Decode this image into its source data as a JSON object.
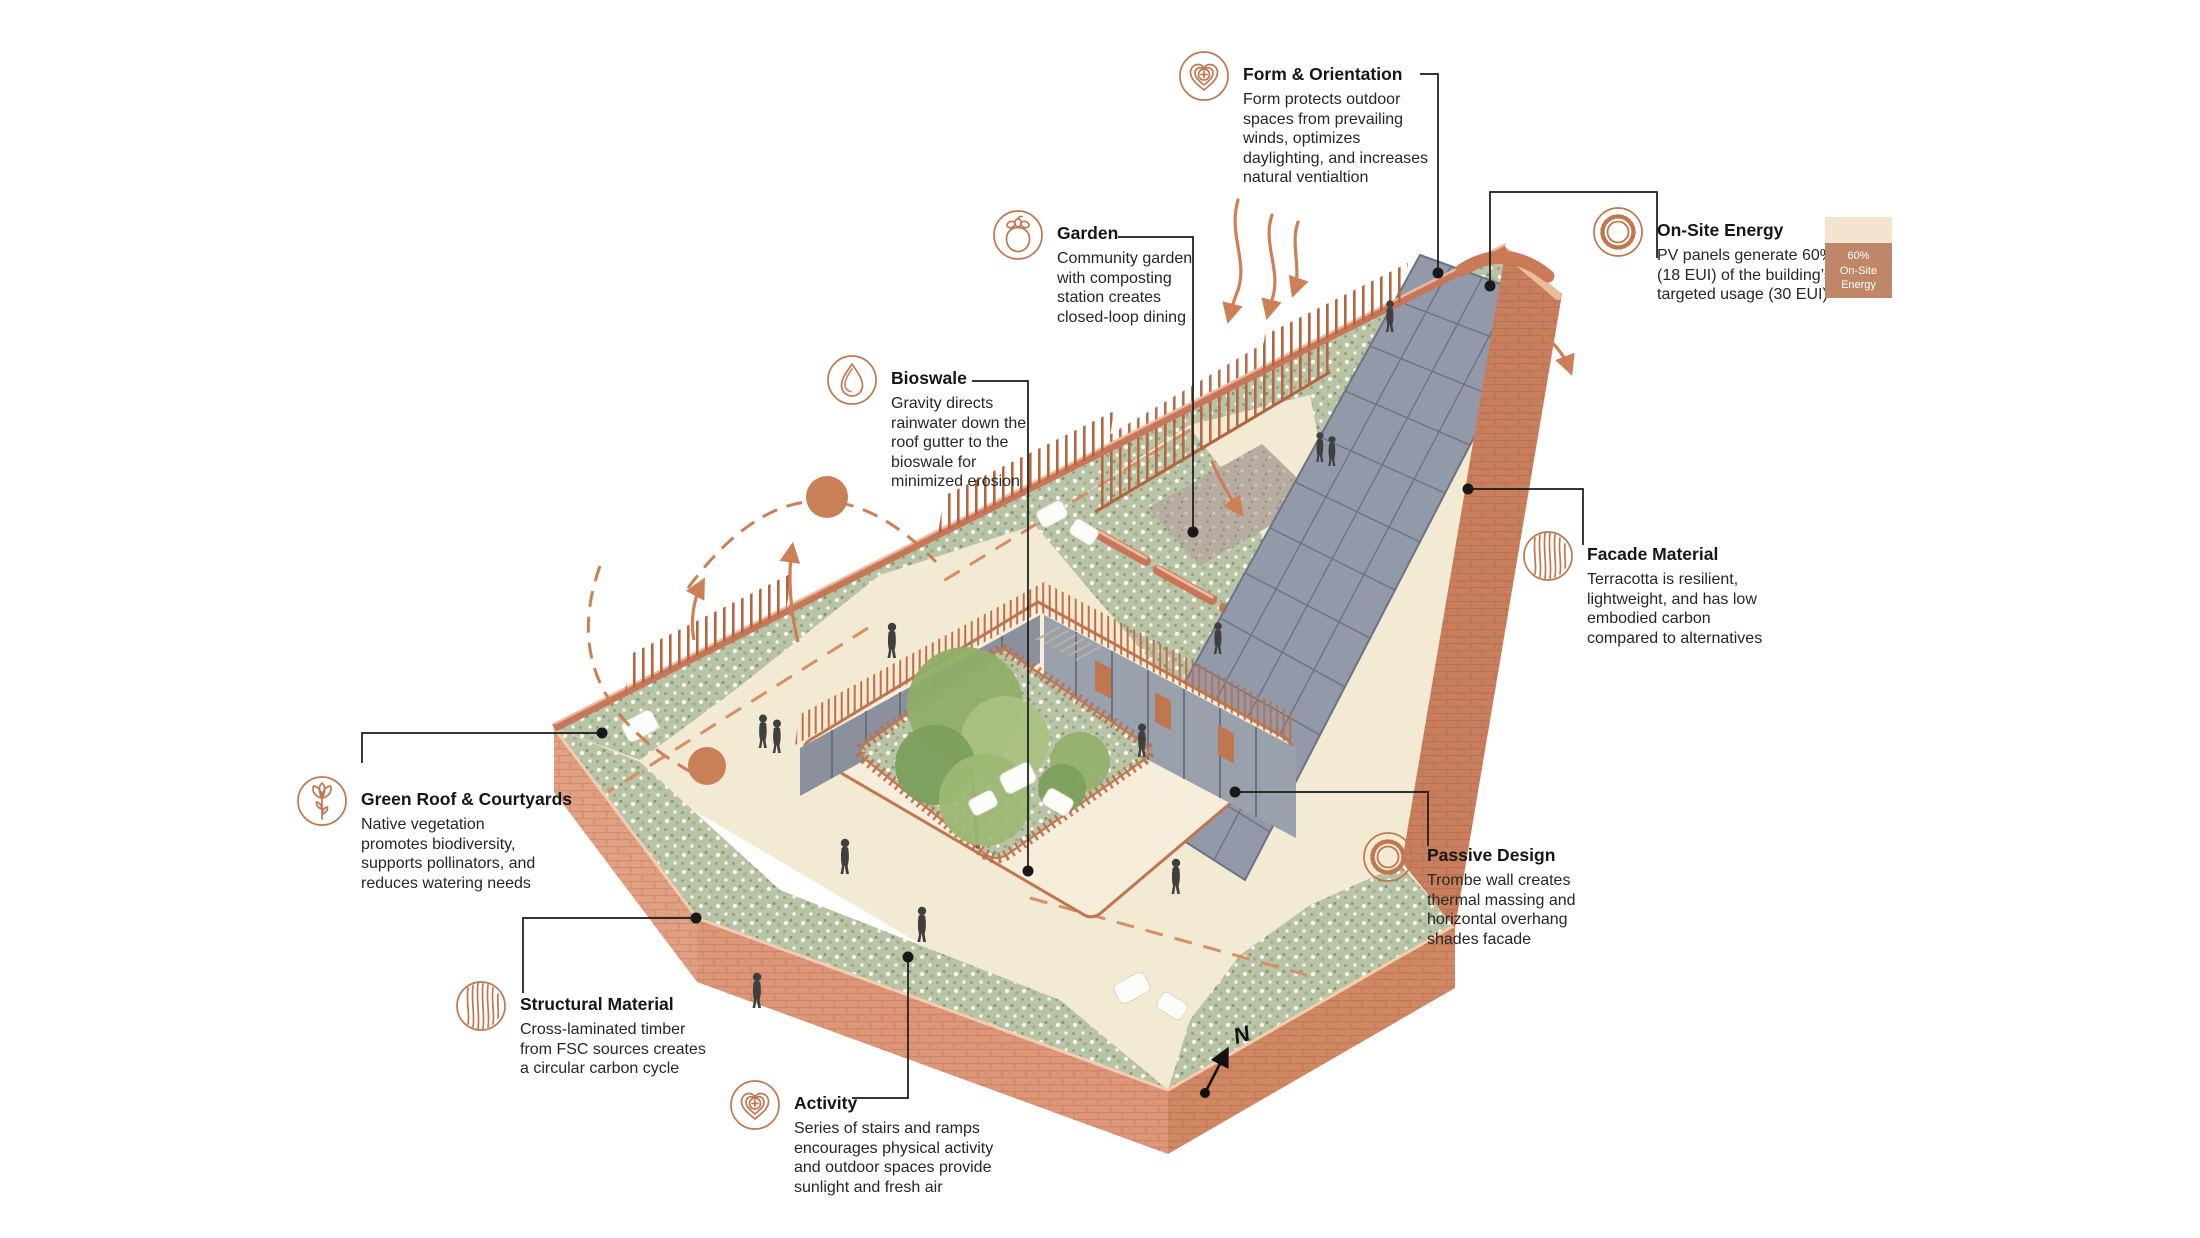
{
  "diagram_title": "Sustainable building design axonometric diagram",
  "callouts": [
    {
      "id": "form-orientation",
      "icon": "wellness-heart-icon",
      "title": "Form & Orientation",
      "body": "Form protects outdoor\nspaces from prevailing\nwinds, optimizes\ndaylighting, and increases\nnatural ventialtion"
    },
    {
      "id": "garden",
      "icon": "fruit-icon",
      "title": "Garden",
      "body": "Community garden\nwith composting\nstation creates\nclosed-loop dining"
    },
    {
      "id": "bioswale",
      "icon": "water-drop-icon",
      "title": "Bioswale",
      "body": "Gravity directs\nrainwater down the\nroof gutter to the\nbioswale for\nminimized erosion"
    },
    {
      "id": "on-site-energy",
      "icon": "sun-icon",
      "title": "On-Site Energy",
      "body": "PV panels generate 60%\n(18 EUI) of the building’s\ntargeted usage (30 EUI)"
    },
    {
      "id": "facade-material",
      "icon": "wood-grain-icon",
      "title": "Facade Material",
      "body": "Terracotta is resilient,\nlightweight, and has low\nembodied carbon\ncompared to alternatives"
    },
    {
      "id": "green-roof",
      "icon": "flower-icon",
      "title": "Green Roof & Courtyards",
      "body": "Native vegetation\npromotes biodiversity,\nsupports pollinators, and\nreduces watering needs"
    },
    {
      "id": "structural-material",
      "icon": "wood-grain-icon",
      "title": "Structural Material",
      "body": "Cross-laminated timber\nfrom FSC sources creates\na circular carbon cycle"
    },
    {
      "id": "activity",
      "icon": "wellness-heart-icon",
      "title": "Activity",
      "body": "Series of stairs and ramps\nencourages physical activity\nand outdoor spaces provide\nsunlight and fresh air"
    },
    {
      "id": "passive-design",
      "icon": "sun-icon",
      "title": "Passive Design",
      "body": "Trombe wall creates\nthermal massing and\nhorizontal overhang\nshades facade"
    }
  ],
  "energy_legend": {
    "percent": "60%",
    "label_line1": "On-Site",
    "label_line2": "Energy"
  },
  "north_label": "N",
  "colors": {
    "terracotta_line": "#c0764f",
    "brick_wall": "#d18a67",
    "green_roof": "#b9c3a6",
    "plaza_cream": "#f3ead4",
    "solar_panel": "#929aa9",
    "legend_top": "#f2e4cf",
    "legend_bottom": "#bf8767",
    "leader_black": "#191919"
  }
}
